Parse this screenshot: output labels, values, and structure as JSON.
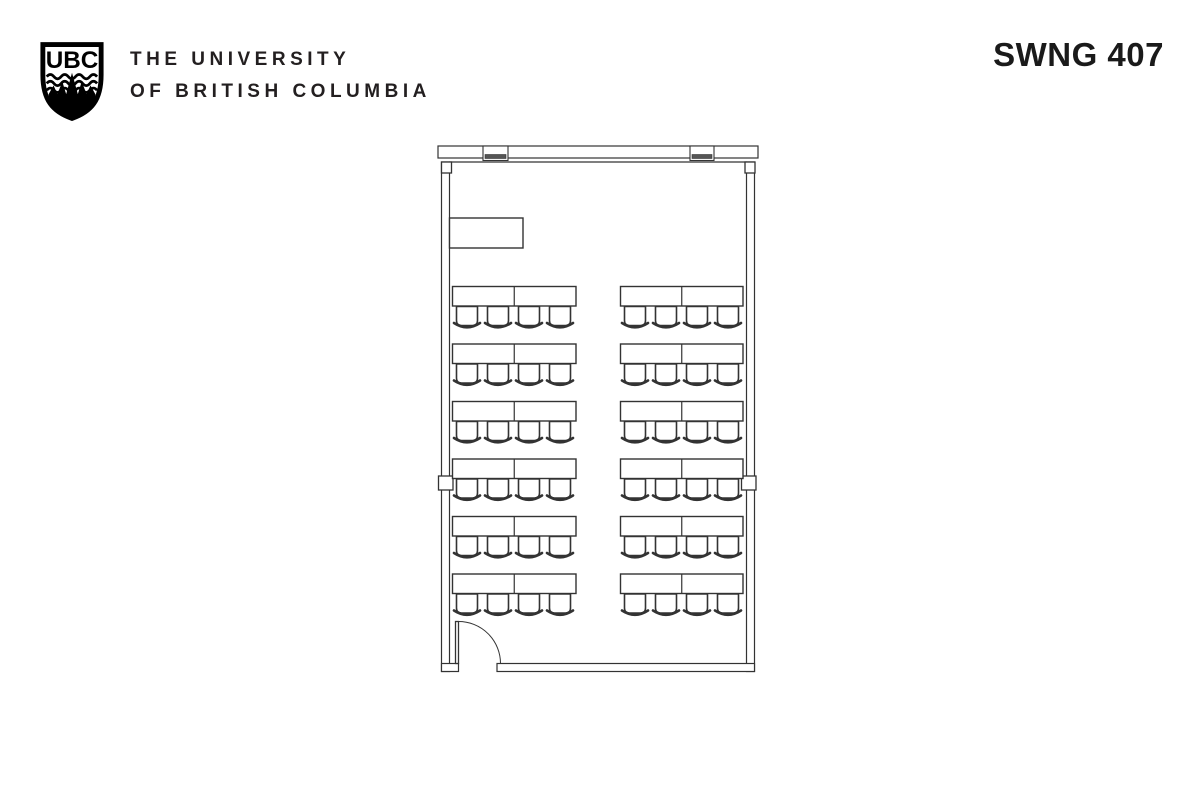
{
  "header": {
    "logo_monogram": "UBC",
    "wordmark_line1": "THE UNIVERSITY",
    "wordmark_line2": "OF BRITISH COLUMBIA",
    "room_label": "SWNG 407"
  },
  "colors": {
    "ink": "#231f20",
    "line": "#333333",
    "background": "#ffffff",
    "mullion_fill": "#555555"
  },
  "floor_plan": {
    "description": "classroom floor plan, top-view",
    "stroke": "#333333",
    "mullion_fill": "#555555",
    "band": {
      "x": 438,
      "y": 146,
      "w": 320,
      "h": 12
    },
    "inner_top_y": 162,
    "mullions": [
      {
        "x": 483,
        "w": 25
      },
      {
        "x": 690,
        "w": 24
      }
    ],
    "walls": [
      {
        "name": "left-wall",
        "x": 441.5,
        "y": 162,
        "w": 8,
        "h": 509.5
      },
      {
        "name": "right-wall",
        "x": 746.5,
        "y": 162,
        "w": 8,
        "h": 509.5
      },
      {
        "name": "bottom-wall-stub",
        "x": 441.5,
        "y": 663.5,
        "w": 17,
        "h": 8
      },
      {
        "name": "bottom-wall",
        "x": 497,
        "y": 663.5,
        "w": 257.5,
        "h": 8
      }
    ],
    "columns": [
      {
        "name": "column-top-left",
        "x": 441.5,
        "y": 162,
        "w": 10,
        "h": 11
      },
      {
        "name": "column-top-right",
        "x": 745,
        "y": 162,
        "w": 10,
        "h": 11
      },
      {
        "name": "column-mid-left",
        "x": 438.5,
        "y": 476,
        "w": 14.5,
        "h": 14
      },
      {
        "name": "column-mid-right",
        "x": 741.5,
        "y": 476,
        "w": 14.5,
        "h": 14
      }
    ],
    "lectern": {
      "x": 449.5,
      "y": 218,
      "w": 73.5,
      "h": 30
    },
    "door": {
      "leaf": {
        "x": 455.5,
        "y": 621.5,
        "w": 3,
        "h": 42
      },
      "arc_radius": 42,
      "hinge": {
        "x": 458.5,
        "y": 663.5
      },
      "swing": "inward"
    },
    "seating": {
      "rows": 6,
      "row_start_y": 286.5,
      "row_pitch": 57.5,
      "table_h": 19.5,
      "chair_w": 21,
      "chair_h": 19,
      "chair_offsets": [
        4,
        35,
        66,
        97
      ],
      "groups": [
        {
          "x": 452.5,
          "w": 123.5
        },
        {
          "x": 620.5,
          "w": 122.5
        }
      ],
      "tables_per_group": 2,
      "chairs_per_group": 4,
      "total_tables": 24,
      "total_chairs": 48
    }
  }
}
